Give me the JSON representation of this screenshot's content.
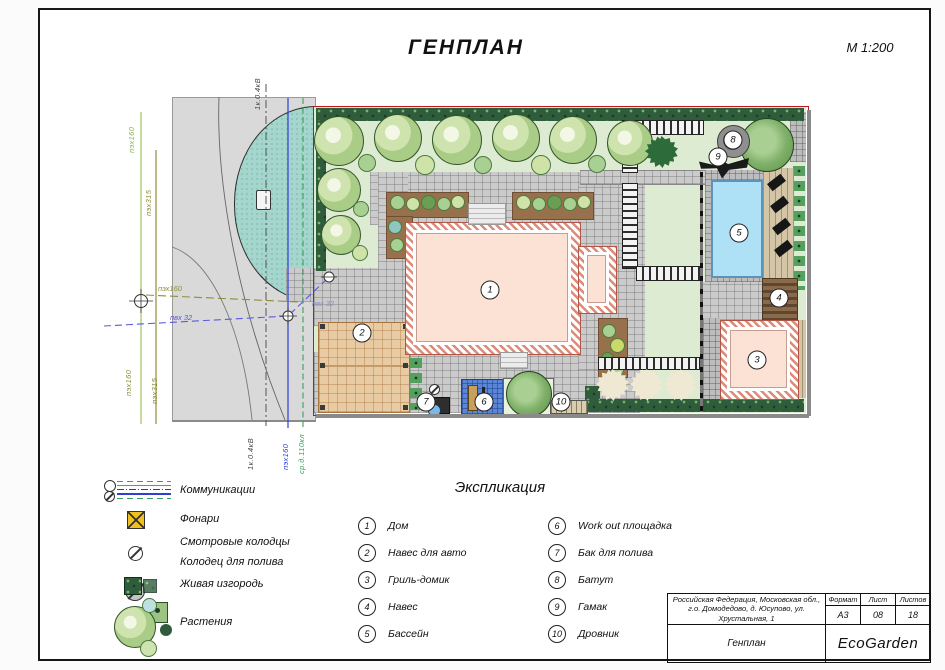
{
  "sheet": {
    "title": "ГЕНПЛАН",
    "scale": "М 1:200"
  },
  "plan": {
    "markers": [
      "1",
      "2",
      "3",
      "4",
      "5",
      "6",
      "7",
      "8",
      "9",
      "10"
    ],
    "utilities": {
      "left_line1_top": "пэх160",
      "left_line2_top": "пэх315",
      "left_line1_bottom": "пэх160",
      "left_line2_bottom": "пэх315",
      "h_line_olive": "пэх160",
      "h_line_blue": "пвх 32",
      "h_line_blue_inner": "пвх 32",
      "cable_top": "1к.0.4кВ",
      "cable_bottom": "1к.0.4кВ",
      "water_bottom": "пэх160",
      "sewer_bottom": "ср.д.110кл"
    }
  },
  "legend": {
    "items": [
      {
        "label": "Коммуникации"
      },
      {
        "label": "Фонари"
      },
      {
        "label": "Смотровые колодцы"
      },
      {
        "label": "Колодец для полива"
      },
      {
        "label": "Живая изгородь"
      },
      {
        "label": "Растения"
      }
    ]
  },
  "explication": {
    "title": "Экспликация",
    "items": [
      {
        "num": "1",
        "label": "Дом"
      },
      {
        "num": "2",
        "label": "Навес для авто"
      },
      {
        "num": "3",
        "label": "Гриль-домик"
      },
      {
        "num": "4",
        "label": "Навес"
      },
      {
        "num": "5",
        "label": "Бассейн"
      },
      {
        "num": "6",
        "label": "Work out площадка"
      },
      {
        "num": "7",
        "label": "Бак для полива"
      },
      {
        "num": "8",
        "label": "Батут"
      },
      {
        "num": "9",
        "label": "Гамак"
      },
      {
        "num": "10",
        "label": "Дровник"
      }
    ]
  },
  "title_block": {
    "address": "Российская Федерация, Московская обл., г.о. Домодедово, д. Юсупово, ул. Хрустальная, 1",
    "format_label": "Формат",
    "format_value": "А3",
    "sheet_label": "Лист",
    "sheet_value": "08",
    "sheets_label": "Листов",
    "sheets_value": "18",
    "drawing_name": "Генплан",
    "company": "EcoGarden"
  },
  "colors": {
    "boundary_red": "#c01818",
    "lawn": "#dcebd2",
    "hedge": "#2f5d3c",
    "paving": "#cbcbcb",
    "house_fill": "#fbe2d4",
    "pool_water": "#aee0f6",
    "carport": "#e9cba3",
    "pond": "#a5d6cd",
    "deck": "#d3c5a5",
    "workout_mat": "#5b86d6"
  }
}
